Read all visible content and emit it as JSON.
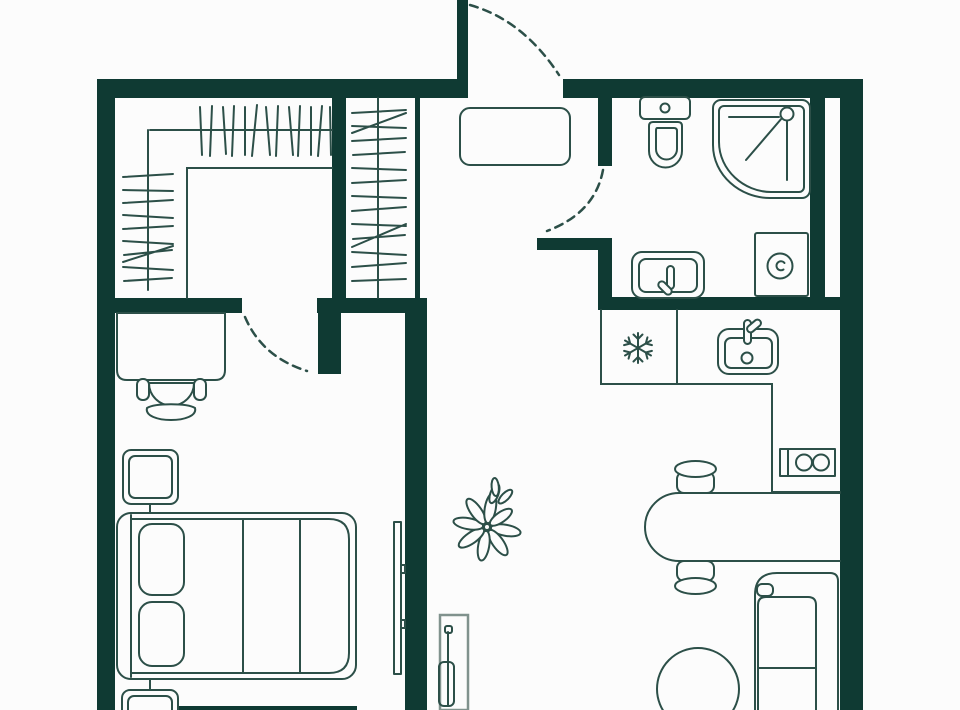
{
  "canvas": {
    "width": 960,
    "height": 710
  },
  "palette": {
    "wall": "#0f3a33",
    "line": "#2c4f48",
    "console_line": "#80928d",
    "background": "#fcfcfc"
  },
  "floorplan": {
    "type": "apartment-floor-plan",
    "rooms": [
      {
        "name": "wardrobe-room"
      },
      {
        "name": "entry-hall"
      },
      {
        "name": "bathroom"
      },
      {
        "name": "bedroom"
      },
      {
        "name": "kitchen-living-room"
      }
    ],
    "doors": [
      "entry-door",
      "wardrobe-bedroom-door",
      "bathroom-door"
    ],
    "furniture": [
      "hanging-rail-top",
      "hanging-rail-left",
      "coat-closet-rail",
      "entry-bench",
      "desk",
      "desk-chair",
      "nightstand-top",
      "nightstand-bottom",
      "double-bed",
      "tv-panel",
      "hall-console",
      "plant",
      "toilet",
      "shower-cabin",
      "washbasin",
      "washing-machine",
      "ventilation-shaft",
      "fridge",
      "kitchen-sink",
      "kitchen-counter",
      "cooktop-socket",
      "dining-table",
      "dining-chair-top",
      "dining-chair-bottom",
      "sofa",
      "round-ottoman"
    ]
  }
}
